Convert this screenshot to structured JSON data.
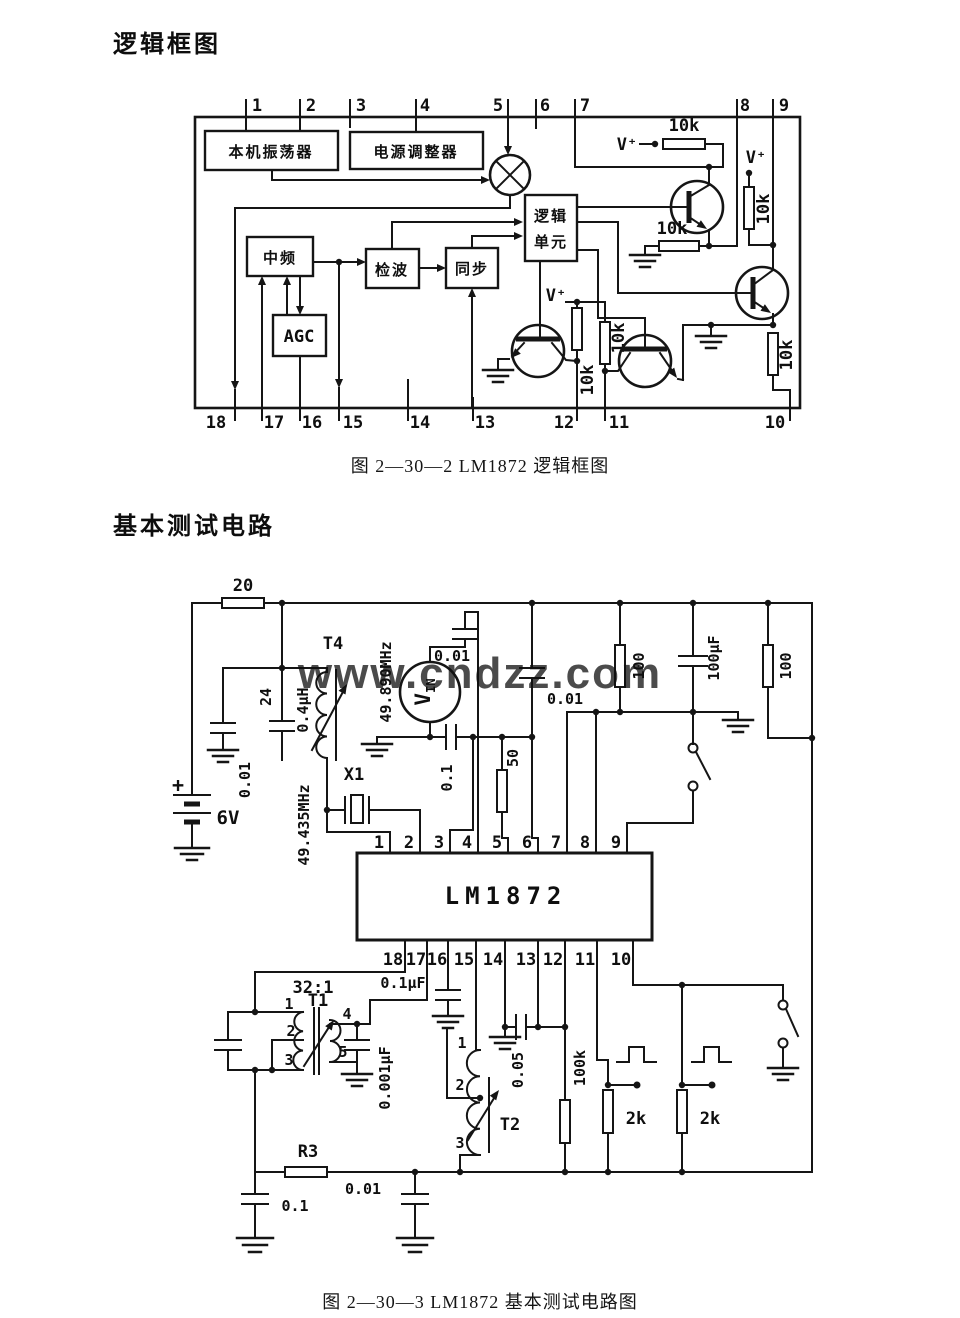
{
  "page": {
    "title1": "逻辑框图",
    "caption1": "图 2—30—2  LM1872 逻辑框图",
    "title2": "基本测试电路",
    "caption2": "图 2—30—3  LM1872 基本测试电路图",
    "watermark": "www.cndzz.com",
    "watermark_color": "#56c3ea"
  },
  "diagram1": {
    "top_pins": [
      "1",
      "2",
      "3",
      "4",
      "5",
      "6",
      "7",
      "8",
      "9"
    ],
    "bottom_pins": [
      "18",
      "17",
      "16",
      "15",
      "14",
      "13",
      "12",
      "11",
      "10"
    ],
    "blocks": {
      "osc": "本机振荡器",
      "reg": "电源调整器",
      "logic_l1": "逻辑",
      "logic_l2": "单元",
      "if_amp": "中频",
      "det": "检波",
      "sync": "同步",
      "agc": "AGC"
    },
    "vplus": "V⁺",
    "r10k": "10k"
  },
  "diagram2": {
    "ic": "LM1872",
    "top_pins": [
      "1",
      "2",
      "3",
      "4",
      "5",
      "6",
      "7",
      "8",
      "9"
    ],
    "bottom_pins": [
      "18",
      "17",
      "16",
      "15",
      "14",
      "13",
      "12",
      "11",
      "10"
    ],
    "components": {
      "r20": "20",
      "t4": "T4",
      "l04": "0.4μH",
      "c24": "24",
      "c001_osc": "0.01",
      "battery_plus": "+",
      "battery": "6V",
      "xtal": "X1",
      "f_xtal": "49.435MHz",
      "f_in": "49.890MHz",
      "vin_main": "V",
      "vin_sub": "IN",
      "c001_in": "0.01",
      "c01_ser": "0.1",
      "r50": "50",
      "c001_mid": "0.01",
      "r100_a": "100",
      "c100uf": "100μF",
      "r100_b": "100",
      "t1_ratio": "32:1",
      "t1": "T1",
      "t1_p1": "1",
      "t1_p2": "2",
      "t1_p3": "3",
      "t1_p4": "4",
      "t1_p5": "5",
      "c01uf": "0.1μF",
      "c0001uf": "0.001μF",
      "t2": "T2",
      "t2_p1": "1",
      "t2_p2": "2",
      "t2_p3": "3",
      "c005": "0.05",
      "r100k": "100k",
      "r2k_a": "2k",
      "r2k_b": "2k",
      "r3": "R3",
      "c001_bot": "0.01",
      "c01_bot": "0.1"
    }
  }
}
